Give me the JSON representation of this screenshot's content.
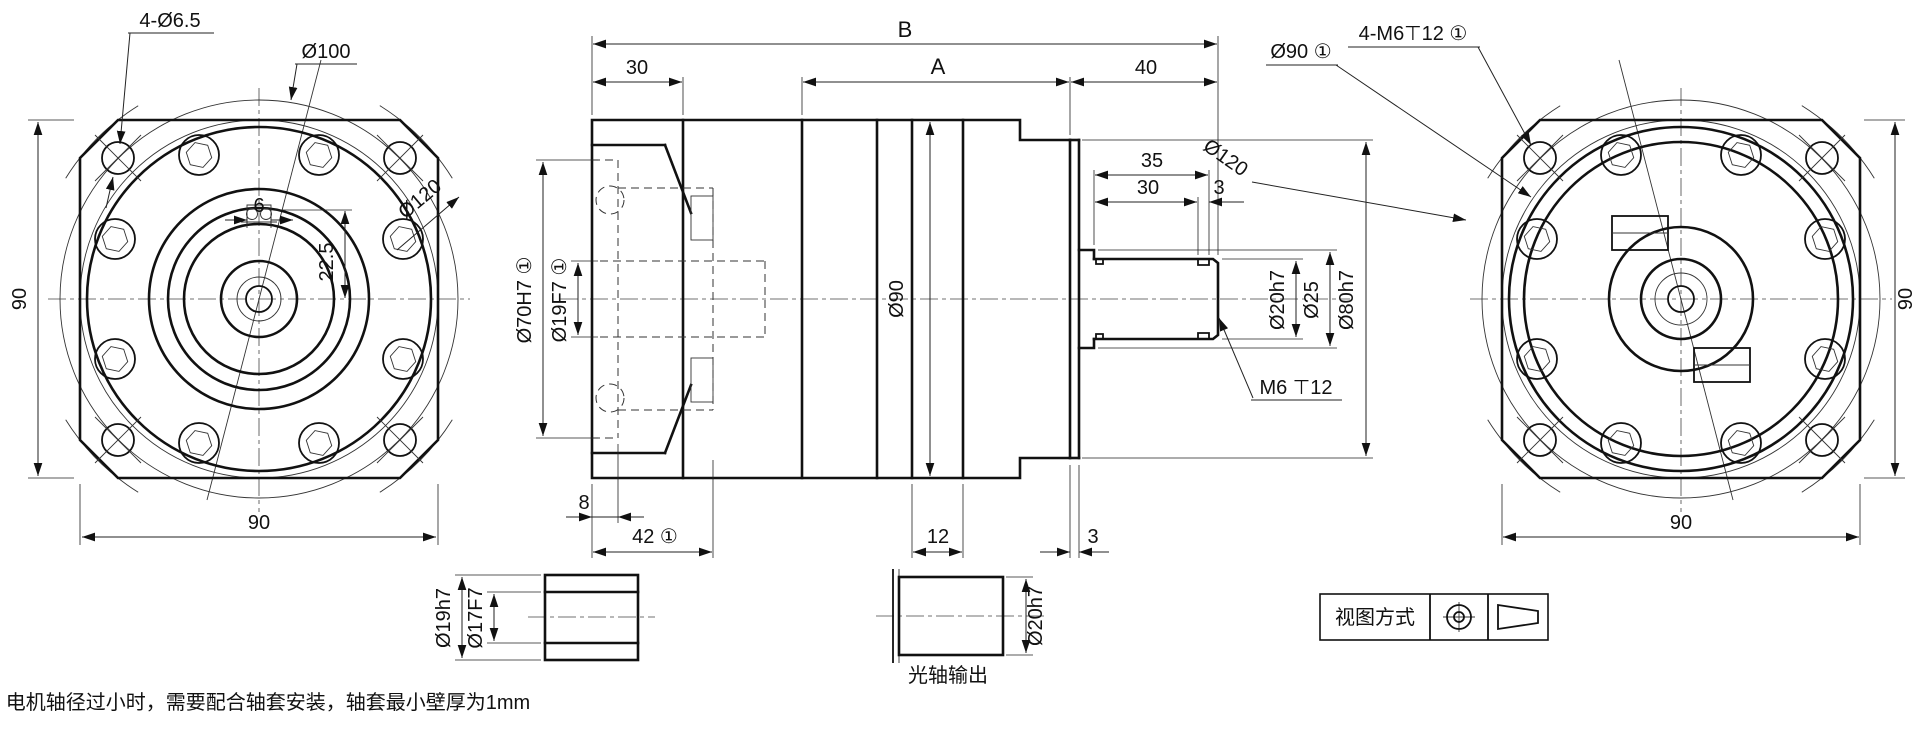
{
  "views": {
    "front": {
      "holes": "4-Ø6.5",
      "bolt_circle": "Ø100",
      "corner_dia": "Ø120",
      "key_width": "6",
      "key_height": "22.5",
      "height": "90",
      "width": "90"
    },
    "side": {
      "total_len": "B",
      "flange_len": "30",
      "body_len": "A",
      "shaft_ext": "40",
      "shaft_35": "35",
      "shaft_30": "30",
      "groove_3": "3",
      "body_dia": "Ø90",
      "pilot_dia": "Ø70H7 ①",
      "bore_dia": "Ø19F7 ①",
      "pilot_depth": "8",
      "cavity_depth": "42 ①",
      "ring_12": "12",
      "face_3": "3",
      "shaft_dia": "Ø20h7",
      "collar_dia": "Ø25",
      "boss_dia": "Ø80h7",
      "tap": "M6 ⊤12"
    },
    "rear": {
      "body_circle": "Ø90 ①",
      "taps": "4-M6⊤12 ①",
      "corner_dia": "Ø120",
      "height": "90",
      "width": "90"
    }
  },
  "details": {
    "bushing": {
      "outer": "Ø19h7",
      "inner": "Ø17F7"
    },
    "plain_shaft": {
      "dia": "Ø20h7",
      "caption": "光轴输出"
    }
  },
  "projection_box": {
    "label": "视图方式"
  },
  "note": "电机轴径过小时，需要配合轴套安装，轴套最小壁厚为1mm"
}
